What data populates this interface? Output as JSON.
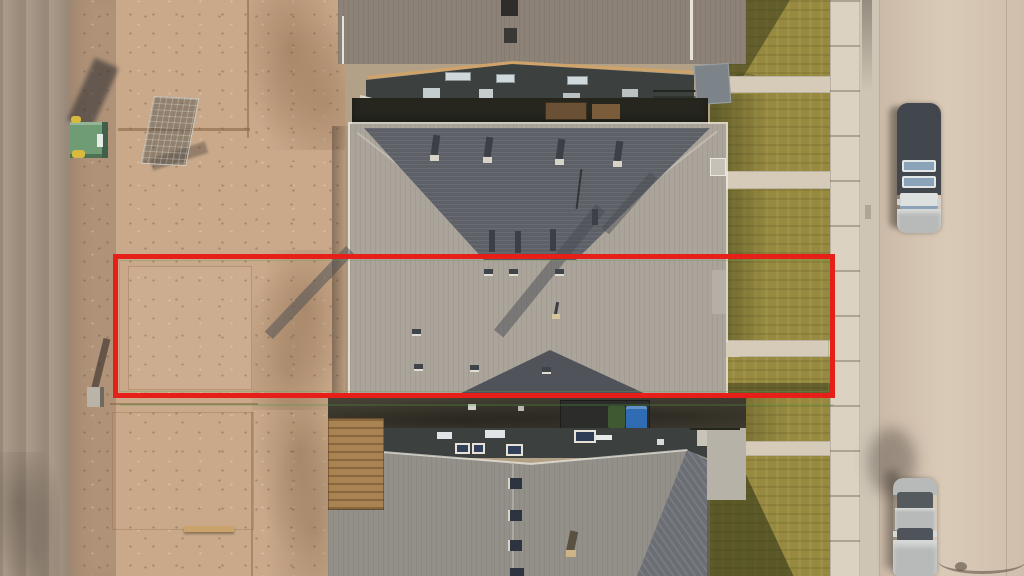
{
  "scene": {
    "description": "Aerial drone photograph of a suburban street: vacant graded dirt lots and a dirt road on the left, a row of duplex houses with gray hip roofs in the middle, dry front lawns, a sidewalk and a light concrete street with two parked vehicles on the right. A red rectangle annotation outlines one half of the middle duplex and its lot from the dirt yard to the front lawn.",
    "annotation": {
      "type": "highlight-rectangle",
      "color": "#e62018"
    },
    "palette": {
      "road_left": "#99897a",
      "shoulder": "#af9278",
      "dirt": "#c9a98a",
      "alley_shadow": "#26261f",
      "roof_mid_light": "#aba49a",
      "roof_mid_dark": "#5d6167",
      "roof_top_house": "#8d8277",
      "roof_bottom_house": "#93908a",
      "roof_bottom_dark": "#6b6e74",
      "wall_dark": "#3c403f",
      "fascia_tan": "#d0a469",
      "grass": "#97893f",
      "grass_shadow": "#5c622e",
      "walkway": "#d6cbb9",
      "sidewalk": "#dcd2c2",
      "curb": "#cfc5b5",
      "street": "#d5c4b1",
      "car_dark": "#42464d",
      "car_silver": "#b7bab8",
      "glass_blue": "#8ba3b8",
      "bin_blue": "#2f6cb4",
      "bin_green": "#3f5a33",
      "dumpster_green": "#6f9c74",
      "wood_deck": "#a98352",
      "trim_white": "#e9e4da"
    },
    "objects": [
      "dirt road",
      "vacant graded lots",
      "construction mesh fence panel",
      "green dumpster",
      "utility marker post",
      "top neighbouring house",
      "middle duplex with hip roof and roof vents",
      "bottom neighbouring house",
      "blue recycling bin",
      "wood deck",
      "dry front lawns",
      "concrete walkways",
      "sidewalk",
      "street",
      "parked dark suv",
      "parked silver sedan",
      "street-light shadow",
      "red lot outline annotation"
    ]
  }
}
